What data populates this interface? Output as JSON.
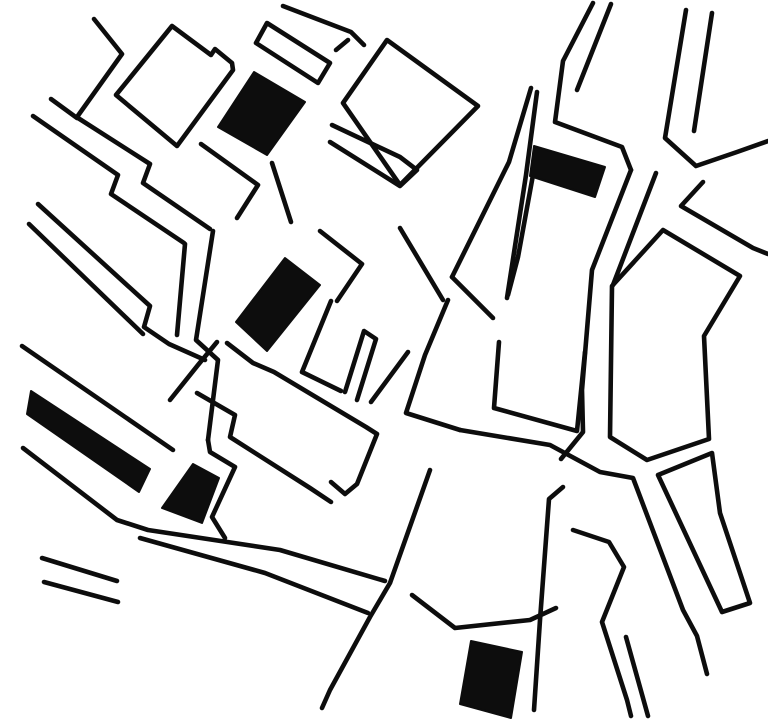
{
  "map": {
    "width": 768,
    "height": 725,
    "background_color": "#ffffff",
    "ink_color": "#0d0d0d",
    "stroke_width": 4.6,
    "description": "hand-drawn-street-map-figure-ground",
    "buildings": [
      {
        "name": "building-1",
        "points": [
          [
            254,
            72
          ],
          [
            305,
            102
          ],
          [
            267,
            155
          ],
          [
            218,
            127
          ]
        ]
      },
      {
        "name": "building-2",
        "points": [
          [
            534,
            146
          ],
          [
            605,
            167
          ],
          [
            595,
            197
          ],
          [
            530,
            176
          ]
        ]
      },
      {
        "name": "building-3",
        "points": [
          [
            285,
            258
          ],
          [
            320,
            285
          ],
          [
            267,
            351
          ],
          [
            236,
            322
          ]
        ]
      },
      {
        "name": "building-4",
        "points": [
          [
            31,
            391
          ],
          [
            150,
            469
          ],
          [
            139,
            492
          ],
          [
            27,
            414
          ]
        ]
      },
      {
        "name": "building-5",
        "points": [
          [
            193,
            464
          ],
          [
            219,
            478
          ],
          [
            202,
            523
          ],
          [
            162,
            508
          ]
        ]
      },
      {
        "name": "building-6",
        "points": [
          [
            471,
            641
          ],
          [
            522,
            652
          ],
          [
            511,
            718
          ],
          [
            460,
            704
          ]
        ]
      }
    ],
    "blocks": [
      {
        "name": "block-topleft-square",
        "points": [
          [
            172,
            26
          ],
          [
            211,
            55
          ],
          [
            215,
            49
          ],
          [
            232,
            63
          ],
          [
            233,
            70
          ],
          [
            177,
            146
          ],
          [
            116,
            95
          ]
        ]
      },
      {
        "name": "block-strip-above-b1",
        "points": [
          [
            267,
            23
          ],
          [
            256,
            43
          ],
          [
            318,
            83
          ],
          [
            330,
            63
          ]
        ]
      },
      {
        "name": "block-center-north",
        "points": [
          [
            387,
            40
          ],
          [
            478,
            106
          ],
          [
            400,
            185
          ],
          [
            343,
            103
          ]
        ]
      },
      {
        "name": "block-east-large",
        "points": [
          [
            663,
            230
          ],
          [
            740,
            276
          ],
          [
            704,
            336
          ],
          [
            709,
            439
          ],
          [
            647,
            460
          ],
          [
            610,
            437
          ],
          [
            612,
            286
          ]
        ]
      },
      {
        "name": "block-east-banana",
        "points": [
          [
            658,
            475
          ],
          [
            712,
            453
          ],
          [
            720,
            513
          ],
          [
            750,
            603
          ],
          [
            722,
            612
          ]
        ]
      }
    ],
    "streets": [
      {
        "name": "street-line",
        "points": [
          [
            94,
            19
          ],
          [
            122,
            54
          ],
          [
            77,
            117
          ]
        ]
      },
      {
        "name": "street-line",
        "points": [
          [
            51,
            99
          ],
          [
            77,
            118
          ]
        ]
      },
      {
        "name": "street-line",
        "points": [
          [
            283,
            6
          ],
          [
            351,
            32
          ],
          [
            364,
            45
          ]
        ]
      },
      {
        "name": "street-line",
        "points": [
          [
            336,
            50
          ],
          [
            348,
            40
          ]
        ]
      },
      {
        "name": "street-line",
        "points": [
          [
            201,
            144
          ],
          [
            258,
            185
          ],
          [
            237,
            218
          ]
        ]
      },
      {
        "name": "street-line",
        "points": [
          [
            272,
            163
          ],
          [
            291,
            222
          ]
        ]
      },
      {
        "name": "street-line",
        "points": [
          [
            78,
            118
          ],
          [
            150,
            164
          ],
          [
            143,
            183
          ],
          [
            210,
            229
          ]
        ]
      },
      {
        "name": "street-line",
        "points": [
          [
            33,
            116
          ],
          [
            118,
            175
          ],
          [
            111,
            194
          ],
          [
            184,
            243
          ]
        ]
      },
      {
        "name": "street-line",
        "points": [
          [
            213,
            231
          ],
          [
            196,
            340
          ],
          [
            218,
            360
          ],
          [
            208,
            440
          ]
        ]
      },
      {
        "name": "street-line",
        "points": [
          [
            185,
            244
          ],
          [
            177,
            335
          ]
        ]
      },
      {
        "name": "street-line",
        "points": [
          [
            38,
            204
          ],
          [
            150,
            306
          ],
          [
            144,
            327
          ],
          [
            169,
            344
          ],
          [
            205,
            360
          ]
        ]
      },
      {
        "name": "street-line",
        "points": [
          [
            29,
            224
          ],
          [
            143,
            334
          ]
        ]
      },
      {
        "name": "street-line",
        "points": [
          [
            217,
            342
          ],
          [
            198,
            365
          ],
          [
            170,
            400
          ]
        ]
      },
      {
        "name": "street-line",
        "points": [
          [
            320,
            231
          ],
          [
            362,
            264
          ],
          [
            337,
            301
          ]
        ]
      },
      {
        "name": "street-line",
        "points": [
          [
            227,
            343
          ],
          [
            253,
            363
          ],
          [
            274,
            372
          ],
          [
            366,
            427
          ],
          [
            377,
            434
          ],
          [
            357,
            484
          ],
          [
            345,
            494
          ],
          [
            331,
            482
          ]
        ]
      },
      {
        "name": "street-line",
        "points": [
          [
            197,
            393
          ],
          [
            235,
            415
          ],
          [
            230,
            437
          ],
          [
            310,
            488
          ],
          [
            331,
            502
          ]
        ]
      },
      {
        "name": "street-line",
        "points": [
          [
            22,
            346
          ],
          [
            173,
            450
          ]
        ]
      },
      {
        "name": "street-line",
        "points": [
          [
            23,
            448
          ],
          [
            117,
            520
          ],
          [
            148,
            530
          ],
          [
            280,
            550
          ],
          [
            385,
            581
          ]
        ]
      },
      {
        "name": "street-line",
        "points": [
          [
            140,
            538
          ],
          [
            265,
            573
          ],
          [
            368,
            613
          ]
        ]
      },
      {
        "name": "street-line",
        "points": [
          [
            430,
            470
          ],
          [
            390,
            583
          ],
          [
            370,
            617
          ],
          [
            330,
            690
          ],
          [
            322,
            708
          ]
        ]
      },
      {
        "name": "street-line",
        "points": [
          [
            208,
            440
          ],
          [
            210,
            452
          ],
          [
            235,
            467
          ],
          [
            212,
            517
          ],
          [
            225,
            538
          ]
        ]
      },
      {
        "name": "street-line",
        "points": [
          [
            42,
            558
          ],
          [
            117,
            581
          ]
        ]
      },
      {
        "name": "street-line",
        "points": [
          [
            44,
            582
          ],
          [
            118,
            602
          ]
        ]
      },
      {
        "name": "street-line",
        "points": [
          [
            412,
            595
          ],
          [
            455,
            628
          ],
          [
            530,
            620
          ],
          [
            556,
            608
          ]
        ]
      },
      {
        "name": "street-line",
        "points": [
          [
            563,
            487
          ],
          [
            549,
            499
          ],
          [
            540,
            620
          ],
          [
            534,
            710
          ]
        ]
      },
      {
        "name": "street-line",
        "points": [
          [
            573,
            530
          ],
          [
            609,
            542
          ],
          [
            624,
            567
          ],
          [
            602,
            622
          ],
          [
            627,
            700
          ],
          [
            631,
            716
          ]
        ]
      },
      {
        "name": "street-line",
        "points": [
          [
            626,
            637
          ],
          [
            648,
            716
          ]
        ]
      },
      {
        "name": "street-line",
        "points": [
          [
            460,
            430
          ],
          [
            550,
            445
          ],
          [
            600,
            472
          ],
          [
            633,
            478
          ],
          [
            683,
            610
          ],
          [
            697,
            636
          ],
          [
            707,
            674
          ]
        ]
      },
      {
        "name": "street-line",
        "points": [
          [
            448,
            300
          ],
          [
            425,
            355
          ],
          [
            406,
            413
          ],
          [
            460,
            430
          ]
        ]
      },
      {
        "name": "street-line",
        "points": [
          [
            499,
            342
          ],
          [
            494,
            408
          ],
          [
            577,
            431
          ],
          [
            585,
            352
          ]
        ]
      },
      {
        "name": "street-line",
        "points": [
          [
            331,
            301
          ],
          [
            302,
            372
          ],
          [
            341,
            391
          ]
        ]
      },
      {
        "name": "street-line",
        "points": [
          [
            345,
            392
          ],
          [
            364,
            331
          ],
          [
            376,
            339
          ],
          [
            357,
            400
          ]
        ]
      },
      {
        "name": "street-line",
        "points": [
          [
            408,
            352
          ],
          [
            371,
            402
          ]
        ]
      },
      {
        "name": "street-line",
        "points": [
          [
            400,
            228
          ],
          [
            443,
            300
          ]
        ]
      },
      {
        "name": "street-line",
        "points": [
          [
            332,
            125
          ],
          [
            400,
            157
          ],
          [
            417,
            170
          ],
          [
            400,
            186
          ],
          [
            330,
            142
          ]
        ]
      },
      {
        "name": "street-line",
        "points": [
          [
            531,
            88
          ],
          [
            509,
            162
          ],
          [
            452,
            277
          ]
        ]
      },
      {
        "name": "street-line",
        "points": [
          [
            537,
            92
          ],
          [
            526,
            175
          ],
          [
            507,
            298
          ]
        ]
      },
      {
        "name": "street-line",
        "points": [
          [
            452,
            277
          ],
          [
            493,
            318
          ]
        ]
      },
      {
        "name": "street-line",
        "points": [
          [
            533,
            175
          ],
          [
            518,
            257
          ],
          [
            508,
            295
          ]
        ]
      },
      {
        "name": "street-line",
        "points": [
          [
            593,
            3
          ],
          [
            563,
            61
          ],
          [
            555,
            122
          ],
          [
            622,
            147
          ],
          [
            631,
            170
          ]
        ]
      },
      {
        "name": "street-line",
        "points": [
          [
            611,
            4
          ],
          [
            577,
            90
          ]
        ]
      },
      {
        "name": "street-line",
        "points": [
          [
            631,
            170
          ],
          [
            592,
            270
          ],
          [
            582,
            390
          ],
          [
            583,
            432
          ],
          [
            561,
            459
          ]
        ]
      },
      {
        "name": "street-line",
        "points": [
          [
            656,
            173
          ],
          [
            613,
            285
          ]
        ]
      },
      {
        "name": "street-line",
        "points": [
          [
            686,
            10
          ],
          [
            665,
            138
          ],
          [
            696,
            166
          ],
          [
            737,
            152
          ],
          [
            768,
            141
          ]
        ]
      },
      {
        "name": "street-line",
        "points": [
          [
            712,
            13
          ],
          [
            694,
            131
          ]
        ]
      },
      {
        "name": "street-line",
        "points": [
          [
            703,
            182
          ],
          [
            681,
            206
          ],
          [
            753,
            248
          ],
          [
            768,
            254
          ]
        ]
      }
    ]
  }
}
